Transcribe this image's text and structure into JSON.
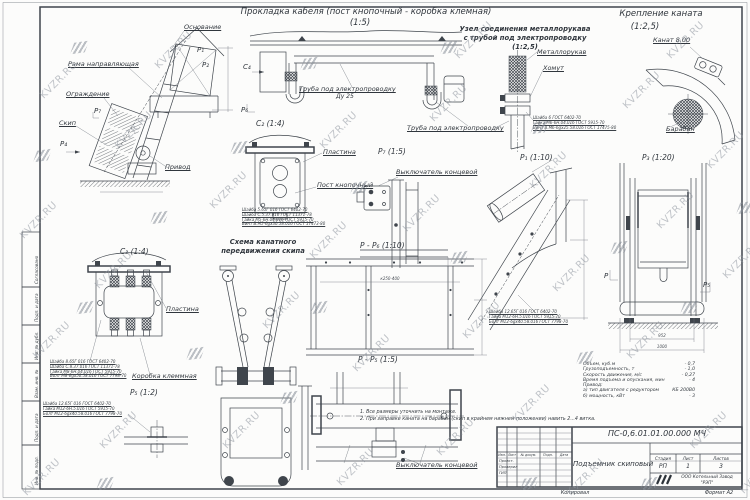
{
  "watermark": {
    "text": "KVZR.RU"
  },
  "page": {
    "copied": "Копировал",
    "format": "Формат А2"
  },
  "titles": {
    "cable": "Прокладка кабеля (пост кнопочный - коробка клемная)",
    "cable_scale": "(1:5)",
    "hose1": "Узел соединения металлорукава",
    "hose2": "с трубой под электропроводку",
    "hose_scale": "(1:2,5)",
    "rope_fix": "Крепление каната",
    "rope_fix_scale": "(1:2,5)",
    "scheme1": "Схема канатного",
    "scheme2": "передвижения скипа"
  },
  "view_labels": {
    "c2": "C₂ (1:4)",
    "c3": "C₃ (1:4)",
    "p7": "P₇ (1:5)",
    "p1": "P₁ (1:10)",
    "p3": "P₃ (1:20)",
    "p5": "P₅ (1:2)",
    "pp6": "P - P₆ (1:10)",
    "pp5": "P - P₅ (1:5)"
  },
  "markers": {
    "p": "P",
    "p1": "P₁",
    "p2": "P₂",
    "p4": "P₄",
    "p5": "P₅",
    "p6": "P₆",
    "p7": "P₇",
    "c4": "C₄"
  },
  "callouts": {
    "osnovanie": "Основание",
    "rama": "Рама направляющая",
    "ograzhdenie": "Ограждение",
    "skip": "Скип",
    "privod": "Привод",
    "truba1": "Труба под электропроводку",
    "du25": "Ду 25",
    "truba2": "Труба под электропроводку",
    "plastina": "Пластина",
    "post": "Пост кнопочный",
    "metallorukav": "Металлорукав",
    "khomut": "Хомут",
    "kanat": "Канат 8.00",
    "baraban": "Барабан",
    "vykl1": "Выключатель концевой",
    "vykl2": "Выключатель концевой",
    "plastina2": "Пластина",
    "korobka": "Коробка клеммная"
  },
  "dims": {
    "p3_inner": "952",
    "p3_outer": "1000",
    "pp6_span": "к250-400"
  },
  "fasteners": {
    "post": [
      "Шайба 5.65Г 016 ГОСТ 6402-70",
      "Шайба С.5.37.016 ГОСТ 11371-78",
      "Гайка М5-6Н.04.016 ГОСТ 5915-70",
      "Винт В.М5-6gх30.58.016 ГОСТ 17473-80"
    ],
    "hose": [
      "Шайба 6 ГОСТ 6402-70",
      "Гайка М6-6Н.04.016 ГОСТ 5915-70",
      "Винт В.М6-6gх25.58.016 ГОСТ 17475-80"
    ],
    "box": [
      "Шайба 8.65Г 016 ГОСТ 6402-70",
      "Шайба С.8.37.016 ГОСТ 11371-78",
      "Гайка М8-6Н.04.016 ГОСТ 5915-70",
      "Болт М8-6gх50.58.016 ГОСТ 7798-70"
    ],
    "bolt": [
      "Шайба 12.65Г 016 ГОСТ 6402-70",
      "Гайка М12-6Н.5.016 ГОСТ 5915-70",
      "Болт М12-6gх40.58.016 ГОСТ 7798-70"
    ],
    "p1": [
      "Шайба 12.65Г 016 ГОСТ 6402-70",
      "Гайка М12-6Н.5.016 ГОСТ 5915-70",
      "Болт М12-6gх40.58.016 ГОСТ 7798-70"
    ]
  },
  "specs": {
    "rows": [
      {
        "label": "Объем, куб.м",
        "value": "- 0,7"
      },
      {
        "label": "Грузоподъемность, т",
        "value": "- 1,0"
      },
      {
        "label": "Скорость движения, м/с",
        "value": "- 0,27"
      },
      {
        "label": "Время подъема и опускания, мин",
        "value": "- 4"
      },
      {
        "label": "Привод:",
        "value": ""
      },
      {
        "label": "а) тип двигателя с редуктором",
        "value": "КБ 200В0"
      },
      {
        "label": "б) мощность, кВт",
        "value": "- 3"
      }
    ]
  },
  "notes": [
    "1. Все размеры уточнить на монтаже.",
    "2. При заправке каната на барабан (скип в крайнем нижнем положении) навить 2...4 витка."
  ],
  "title_block": {
    "doc_number": "ПС-0,6.01.01.00.000 МЧ",
    "title": "Подъемник скиповый",
    "col_izm": "Изм.",
    "col_list": "Лист",
    "col_doc": "№ докум.",
    "col_podp": "Подп.",
    "col_data": "Дата",
    "row1": "Проект.",
    "row2": "Проверил",
    "row3": "ГИП",
    "stage_h": "Стадия",
    "sheet_h": "Лист",
    "sheets_h": "Листов",
    "stage_v": "РП",
    "sheet_v": "1",
    "sheets_v": "3",
    "company_line1": "ООО Котельный Завод",
    "company_line2": "\"РЭП\""
  },
  "side_strip": {
    "soglasovano": "Согласовано",
    "podp1": "Подп. и дата",
    "dubl": "Инв. № дубл.",
    "vzam": "Взам. инв. №",
    "podp2": "Подп. и дата",
    "podl": "Инв. № подл."
  }
}
